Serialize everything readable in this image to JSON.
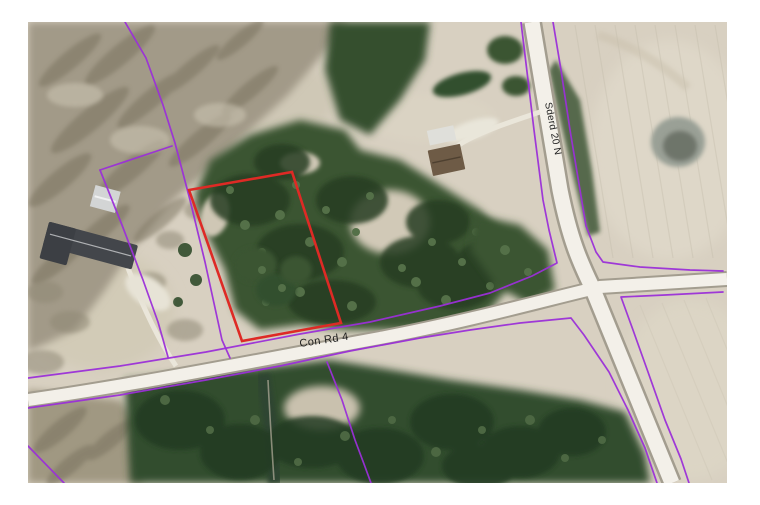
{
  "map": {
    "type": "aerial-parcel-map",
    "road_labels": [
      {
        "id": "con-rd-4",
        "text": "Con Rd 4"
      },
      {
        "id": "sderd-20-n",
        "text": "Sderd 20 N"
      }
    ],
    "highlighted_parcel": {
      "description": "red outlined parcel",
      "outline_color": "#de2a25"
    },
    "colors": {
      "parcel_boundary": "#9b2fd8",
      "highlight_outline": "#de2a25",
      "road_surface": "#f3f0e9",
      "field": "#d8d0c1",
      "conifer_forest": "#35502f",
      "bare_forest": "#a29a88"
    }
  }
}
